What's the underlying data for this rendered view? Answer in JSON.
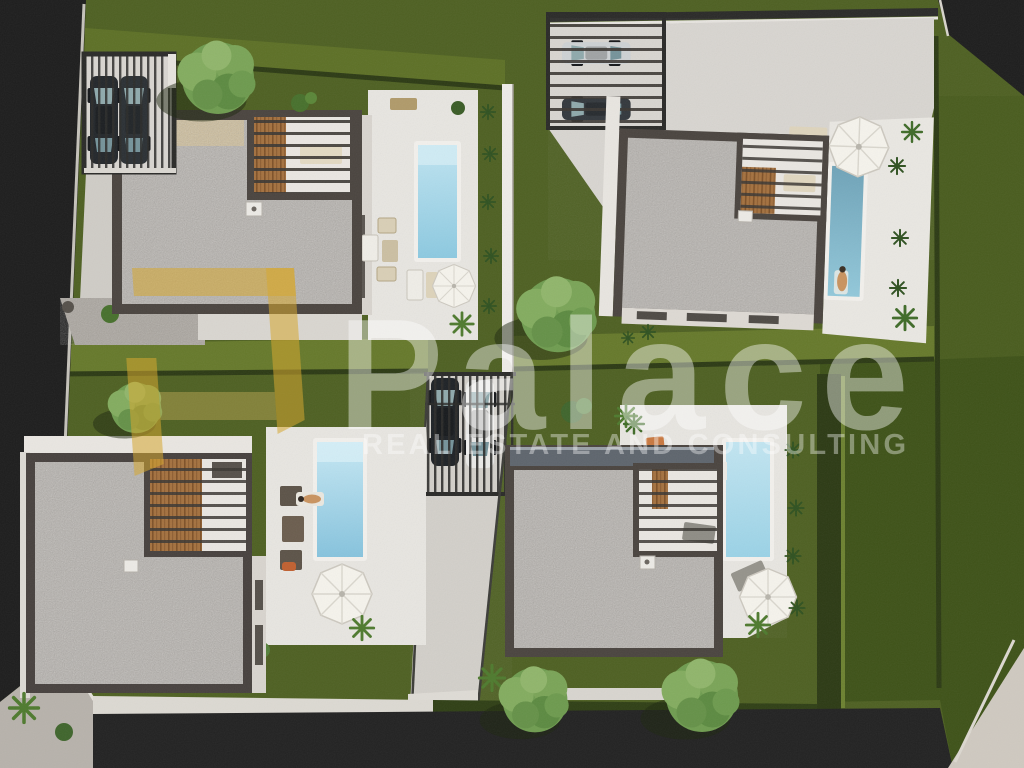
{
  "image": {
    "kind": "3D aerial architectural rendering",
    "subject": "Top-down view of a residential development: four modern flat-roof villas, each with gravel roof, corner pergola, white terrace, private pool, lawn, carports with parked cars, central driveway and surrounding roads"
  },
  "watermark": {
    "brand": "Palace",
    "tagline": "REAL ESTATE AND CONSULTING"
  },
  "palette": {
    "grass_base": "#4e6022",
    "grass_light": "#66792b",
    "grass_dark": "#3e5218",
    "grass_neighbor": "#495c1e",
    "hedge_dark": "#2c3a14",
    "roof_border": "#4a443f",
    "roof_gravel": "#b5b1ac",
    "terrace_white": "#e9e7e2",
    "pavement_light": "#d9d6d1",
    "road_dark": "#1d1d1d",
    "pool_light": "#9ed6ea",
    "pool_deep": "#5f97ae",
    "wood_brown": "#a4713f",
    "logo_yellow": "#d6a832",
    "car_dark": "#23272b",
    "car_white": "#e9e9e7"
  },
  "objects": [
    "villa-roof-gravel",
    "corner-pergola",
    "swimming-pool",
    "white-terrace",
    "carport-with-cars",
    "central-driveway",
    "lawn",
    "hedge",
    "tree",
    "sun-umbrella",
    "sun-lounger",
    "person-sunbathing",
    "road"
  ]
}
